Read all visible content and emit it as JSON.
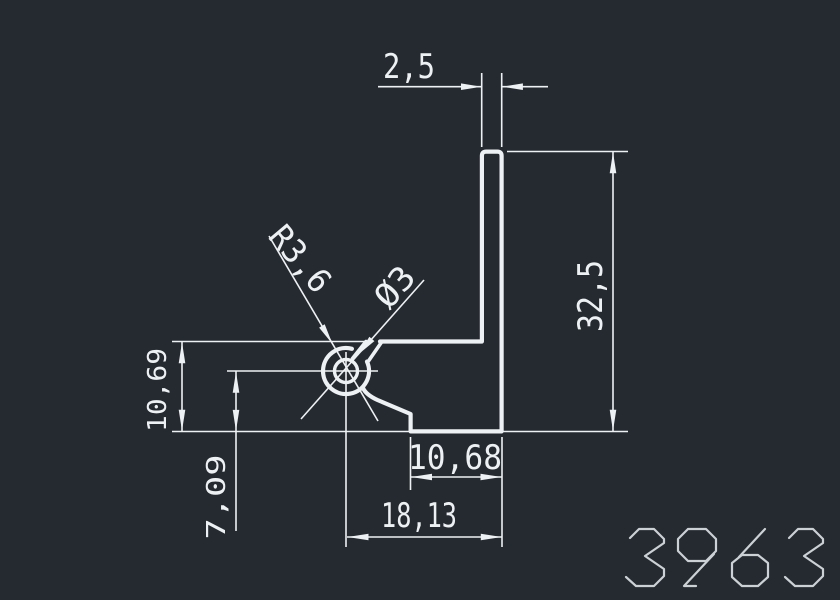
{
  "app": {
    "type": "cad-profile-drawing-viewer"
  },
  "drawing": {
    "number": "3963",
    "colors": {
      "background": "#252a31",
      "lines": "#eef1f3",
      "number_text": "#ccd1d6"
    },
    "dim_texts": {
      "wall_thickness": "2,5",
      "total_height": "32,5",
      "leg_height": "10,69",
      "hole_center_offset": "7,09",
      "bottom_step_width": "10,68",
      "bottom_width": "18,13",
      "boss_radius": "R3,6",
      "hole_diameter": "Ø3"
    }
  }
}
